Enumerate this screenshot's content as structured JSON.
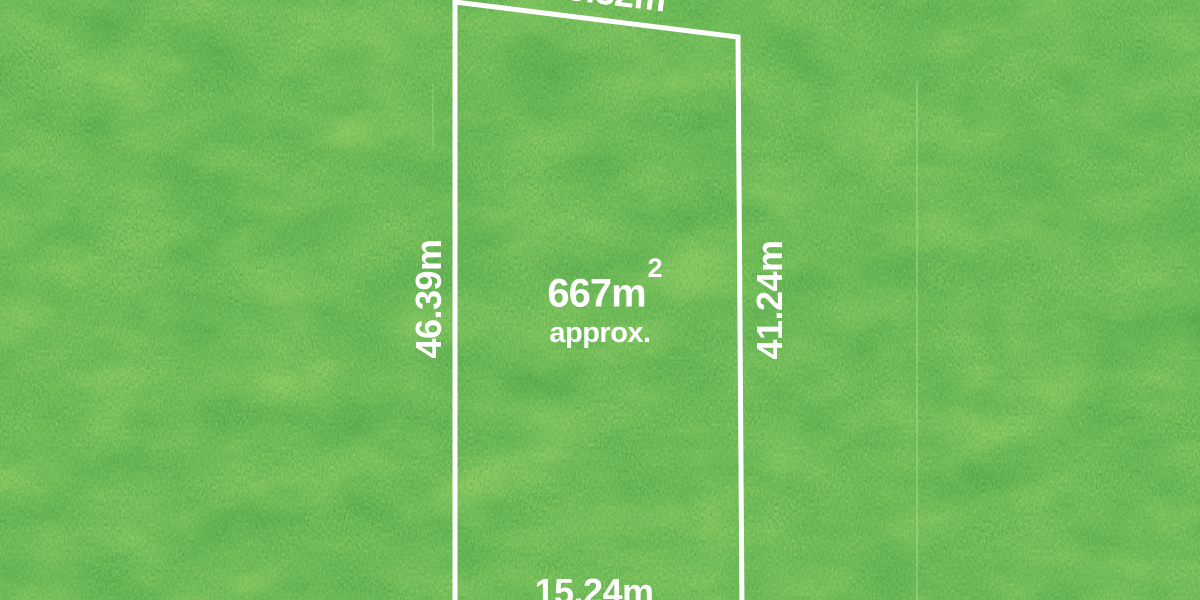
{
  "scene": {
    "description": "aerial grass land lot with white boundary outline and dimensions"
  },
  "colors": {
    "boundary": "#ffffff",
    "label_text": "#ffffff",
    "grass_base": "#2e7d1f",
    "grass_dark": "#17520e",
    "grass_light": "#8fc83c"
  },
  "lot": {
    "area": {
      "value": "667m",
      "superscript": "2",
      "qualifier": "approx."
    },
    "dimensions": {
      "top": "15.32m",
      "left": "46.39m",
      "right": "41.24m",
      "bottom": "15.24m"
    }
  }
}
